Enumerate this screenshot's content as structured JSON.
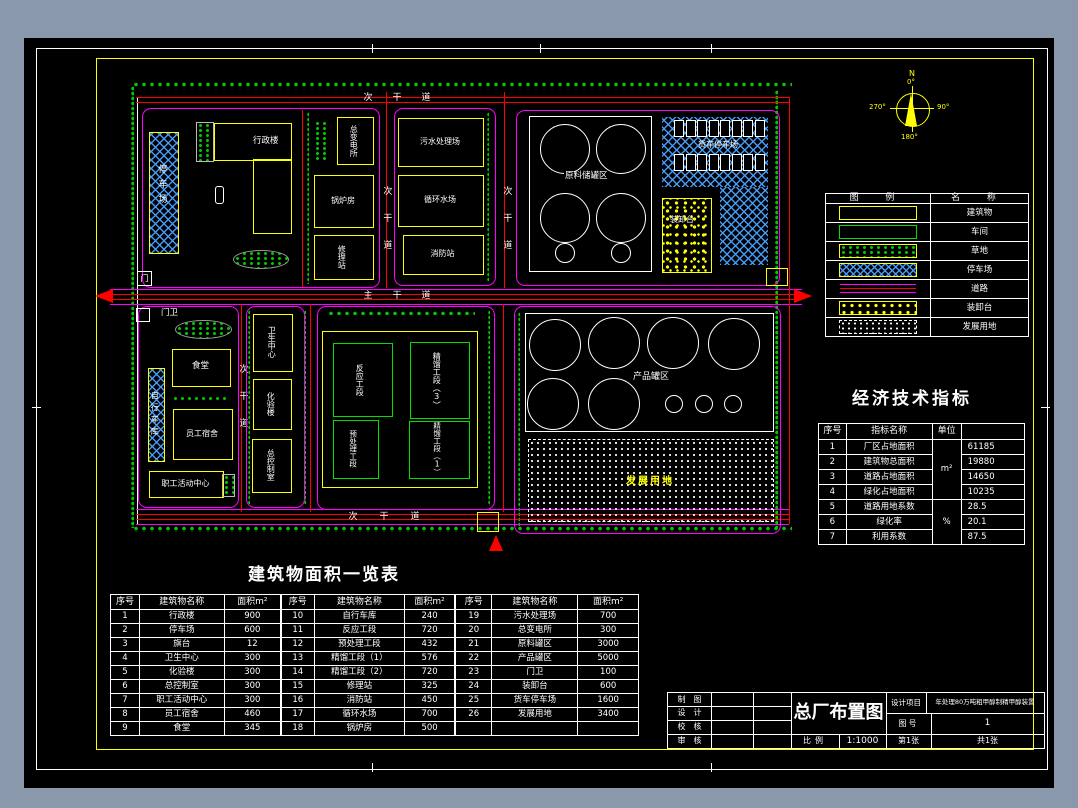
{
  "plan": {
    "roads": {
      "main": "主干道",
      "secondary": "次干道"
    },
    "labels": {
      "parking": "停车场",
      "admin": "行政楼",
      "substation": "总变电所",
      "boiler": "锅炉房",
      "repair": "修理站",
      "gate": "门",
      "sewage": "污水处理场",
      "circwater": "循环水场",
      "fire": "消防站",
      "rawtank": "原料储罐区",
      "truckpark": "货车停车场",
      "loading": "装卸台",
      "gatehouse": "门卫",
      "canteen": "食堂",
      "bike": "自行车库",
      "dorm": "员工宿舍",
      "activity": "职工活动中心",
      "health": "卫生中心",
      "lab": "化验楼",
      "control": "总控制室",
      "reaction": "反应工段",
      "distill3": "精馏工段（3）",
      "pretreat": "预处理工段",
      "distill1": "精馏工段（1）",
      "producttank": "产品罐区",
      "development": "发展用地"
    },
    "compass": {
      "north": "N",
      "deg0": "0°",
      "deg90": "90°",
      "deg180": "180°",
      "deg270": "270°"
    }
  },
  "legend": {
    "header_symbol": "图  例",
    "header_name": "名  称",
    "items": [
      {
        "label": "建筑物",
        "swatch": "yellow-rect"
      },
      {
        "label": "车间",
        "swatch": "green-rect"
      },
      {
        "label": "草地",
        "swatch": "grass-hatch"
      },
      {
        "label": "停车场",
        "swatch": "parking-hatch"
      },
      {
        "label": "道路",
        "swatch": "road-lines"
      },
      {
        "label": "装卸台",
        "swatch": "loading-speckle"
      },
      {
        "label": "发展用地",
        "swatch": "dotted-area"
      }
    ]
  },
  "econ": {
    "title": "经济技术指标",
    "headers": [
      "序号",
      "指标名称",
      "单位",
      ""
    ],
    "unit_area": "m²",
    "unit_pct": "%",
    "rows": [
      {
        "no": "1",
        "name": "厂区占地面积",
        "value": "61185"
      },
      {
        "no": "2",
        "name": "建筑物总面积",
        "value": "19880"
      },
      {
        "no": "3",
        "name": "道路占地面积",
        "value": "14650"
      },
      {
        "no": "4",
        "name": "绿化占地面积",
        "value": "10235"
      },
      {
        "no": "5",
        "name": "道路用地系数",
        "value": "28.5"
      },
      {
        "no": "6",
        "name": "绿化率",
        "value": "20.1"
      },
      {
        "no": "7",
        "name": "利用系数",
        "value": "87.5"
      }
    ]
  },
  "buildings": {
    "title": "建筑物面积一览表",
    "headers": [
      "序号",
      "建筑物名称",
      "面积m²"
    ],
    "groups": [
      [
        {
          "no": "1",
          "name": "行政楼",
          "area": "900"
        },
        {
          "no": "2",
          "name": "停车场",
          "area": "600"
        },
        {
          "no": "3",
          "name": "旗台",
          "area": "12"
        },
        {
          "no": "4",
          "name": "卫生中心",
          "area": "300"
        },
        {
          "no": "5",
          "name": "化验楼",
          "area": "300"
        },
        {
          "no": "6",
          "name": "总控制室",
          "area": "300"
        },
        {
          "no": "7",
          "name": "职工活动中心",
          "area": "300"
        },
        {
          "no": "8",
          "name": "员工宿舍",
          "area": "460"
        },
        {
          "no": "9",
          "name": "食堂",
          "area": "345"
        }
      ],
      [
        {
          "no": "10",
          "name": "自行车库",
          "area": "240"
        },
        {
          "no": "11",
          "name": "反应工段",
          "area": "720"
        },
        {
          "no": "12",
          "name": "预处理工段",
          "area": "432"
        },
        {
          "no": "13",
          "name": "精馏工段（1）",
          "area": "576"
        },
        {
          "no": "14",
          "name": "精馏工段（2）",
          "area": "720"
        },
        {
          "no": "15",
          "name": "修理站",
          "area": "325"
        },
        {
          "no": "16",
          "name": "消防站",
          "area": "450"
        },
        {
          "no": "17",
          "name": "循环水场",
          "area": "700"
        },
        {
          "no": "18",
          "name": "锅炉房",
          "area": "500"
        }
      ],
      [
        {
          "no": "19",
          "name": "污水处理场",
          "area": "700"
        },
        {
          "no": "20",
          "name": "总变电所",
          "area": "300"
        },
        {
          "no": "21",
          "name": "原料罐区",
          "area": "3000"
        },
        {
          "no": "22",
          "name": "产品罐区",
          "area": "5000"
        },
        {
          "no": "23",
          "name": "门卫",
          "area": "100"
        },
        {
          "no": "24",
          "name": "装卸台",
          "area": "600"
        },
        {
          "no": "25",
          "name": "货车停车场",
          "area": "1600"
        },
        {
          "no": "26",
          "name": "发展用地",
          "area": "3400"
        }
      ]
    ]
  },
  "titleblock": {
    "roles": [
      "制图",
      "设计",
      "校核",
      "审核"
    ],
    "drawing_title": "总厂布置图",
    "scale_label": "比例",
    "scale": "1:1000",
    "project_label": "设计项目",
    "project": "年处理80万吨粗甲醇制精甲醇装置",
    "sheet_no_label": "图号",
    "sheet_no": "1",
    "sheet_index": "第1张",
    "sheet_total": "共1张"
  }
}
